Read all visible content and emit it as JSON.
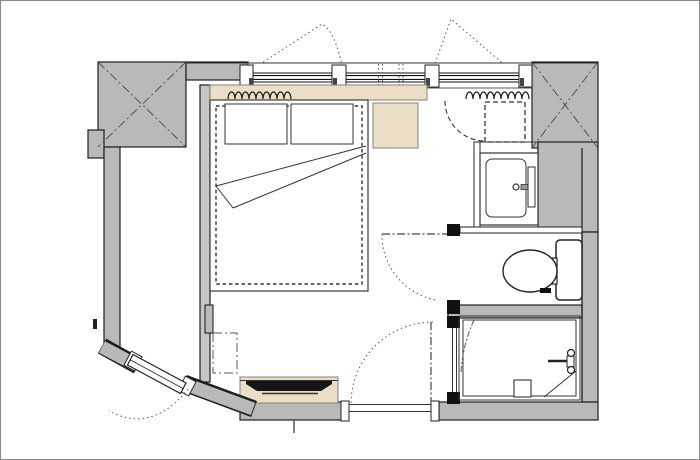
{
  "document": {
    "kind": "architectural-floor-plan",
    "subject": "hotel guest room with bed, entry, washbasin niche, toilet room and shower room",
    "visible_text": []
  },
  "colors": {
    "background": "#ffffff",
    "border": "#8a8a8a",
    "wall_fill": "#b9b9b9",
    "wall_outline": "#1e1e1e",
    "partition_fill": "#c6c6c6",
    "wood_fill": "#eadfc6",
    "wood_outline": "#8a8270",
    "line": "#333333",
    "dash_line": "#555555",
    "tv_screen": "#161616",
    "fixture_white": "#ffffff"
  },
  "elements": {
    "structure": [
      "column-top-left",
      "column-top-right",
      "left-wall",
      "right-wall",
      "bottom-wall",
      "angled-entry-wall",
      "room-partition",
      "duct-wall"
    ],
    "openings": [
      "window-band-left",
      "window-band-right",
      "entry-door",
      "bathroom-door",
      "toilet-door",
      "shower-door",
      "threshold"
    ],
    "furniture": [
      "bed",
      "pillow-left",
      "pillow-right",
      "folded-blanket",
      "headboard-shelf",
      "nightstand",
      "tv-console",
      "tv-screen",
      "wall-cabinet-dashed"
    ],
    "sanitary": [
      "washbasin-counter",
      "basin",
      "faucet",
      "toilet-tank",
      "toilet-bowl",
      "shower-head",
      "floor-drain",
      "corner-shelf-line"
    ],
    "drapery": [
      "curtain-left",
      "curtain-right"
    ]
  }
}
